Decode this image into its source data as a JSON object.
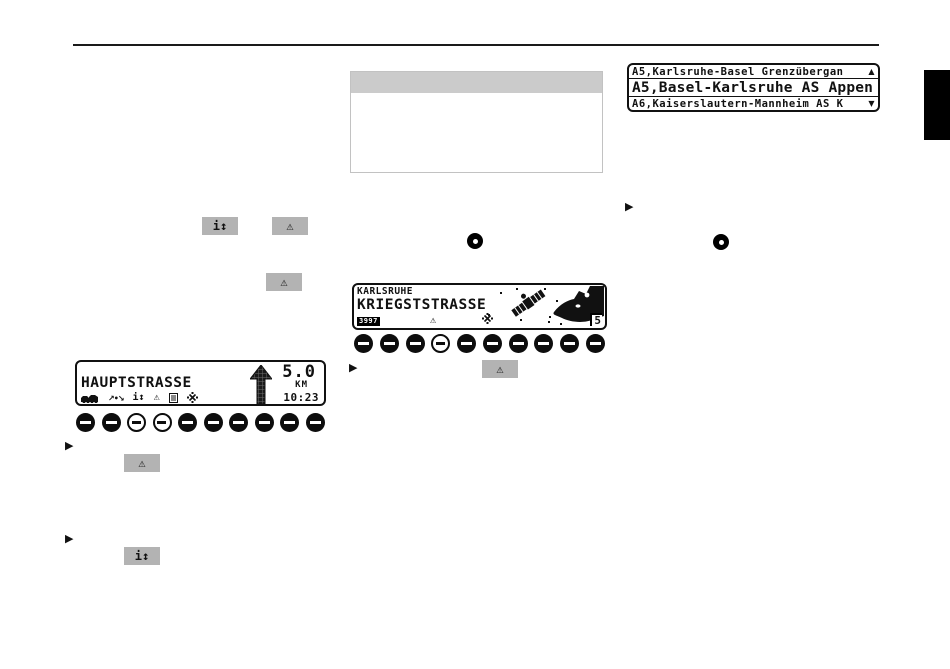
{
  "colors": {
    "badge_gray": "#b3b3b3",
    "table_header_gray": "#cbcbcb",
    "ink": "#111111"
  },
  "icons": {
    "warning": "⚠",
    "info_updown": "i↕",
    "route_arrows": "↗•↘",
    "bullet": "▶",
    "scroll_up": "▲",
    "scroll_down": "▼"
  },
  "nav_list_display": {
    "line1": "A5,Karlsruhe-Basel Grenzübergan",
    "line2": "A5,Basel-Karlsruhe AS Appen",
    "line3": "A6,Kaiserslautern-Mannheim AS K"
  },
  "route_display": {
    "street": "HAUPTSTRASSE",
    "distance": "5.0",
    "unit": "KM",
    "time": "10:23"
  },
  "location_display": {
    "city": "KARLSRUHE",
    "street": "KRIEGSTSTRASSE",
    "station_badge": "3997",
    "satellite_count": "5"
  }
}
